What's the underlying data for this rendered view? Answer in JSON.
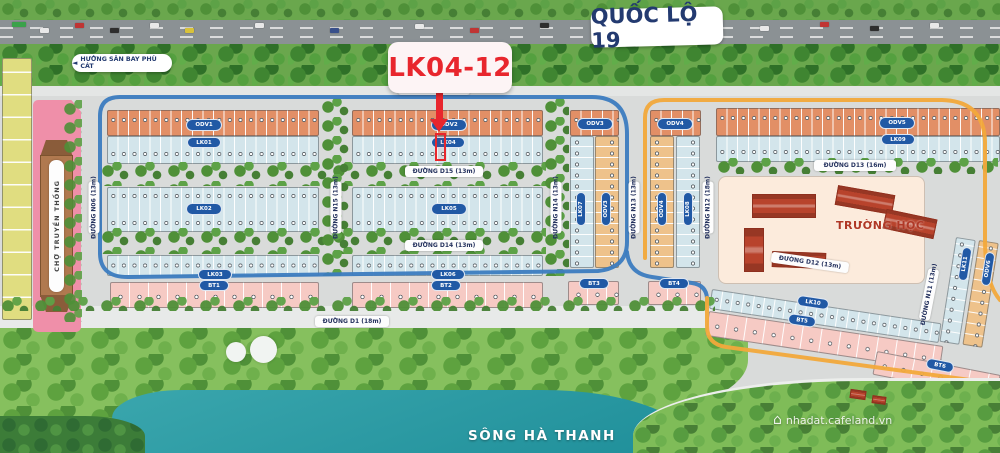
{
  "top": {
    "highway_label": "QUỐC LỘ 19",
    "direction_label": "HƯỚNG SÂN BAY PHÙ CÁT",
    "direction_arrow": "◄"
  },
  "callout": {
    "label": "LK04-12"
  },
  "roads": {
    "d16": "ĐƯỜNG D16 (42m)",
    "d15": "ĐƯỜNG D15 (13m)",
    "d14": "ĐƯỜNG D14 (13m)",
    "d13": "ĐƯỜNG D13 (16m)",
    "d12": "ĐƯỜNG D12 (13m)",
    "d1": "ĐƯỜNG D1 (18m)",
    "n06": "ĐƯỜNG N06 (13m)",
    "n15": "ĐƯỜNG N15 (13m)",
    "n14": "ĐƯỜNG N14 (13m)",
    "n13": "ĐƯỜNG N13 (13m)",
    "n12": "ĐƯỜNG N12 (18m)",
    "n11": "ĐƯỜNG N11 (13m)"
  },
  "blocks": {
    "odv1": "ODV1",
    "odv2": "ODV2",
    "odv3": "ODV3",
    "odv4": "ODV4",
    "odv5": "ODV5",
    "odv6": "ODV6",
    "lk01": "LK01",
    "lk02": "LK02",
    "lk03": "LK03",
    "lk04": "LK04",
    "lk05": "LK05",
    "lk06": "LK06",
    "lk07": "LK07",
    "lk08": "LK08",
    "lk09": "LK09",
    "lk10": "LK10",
    "lk11": "LK11",
    "bt1": "BT1",
    "bt2": "BT2",
    "bt3": "BT3",
    "bt4": "BT4",
    "bt5": "BT5",
    "bt6": "BT6"
  },
  "landmarks": {
    "market": "CHỢ TRUYỀN THỐNG",
    "school": "TRƯỜNG HỌC",
    "river": "SÔNG HÀ THANH"
  },
  "watermark": {
    "site": "nhadat.cafeland.vn",
    "icon": "⌂"
  },
  "colors": {
    "accent_red": "#E8262D",
    "road_blue": "#3C7CC0",
    "road_orange": "#F2A93B",
    "label_blue": "#2159A5",
    "lot_orange": "#E28F66",
    "lot_blue": "#D3E5EB",
    "lot_pink": "#F6CAC4",
    "lot_tan": "#EEC28B",
    "lot_yellow": "#E0DD80",
    "water": "#2B9AA4"
  }
}
